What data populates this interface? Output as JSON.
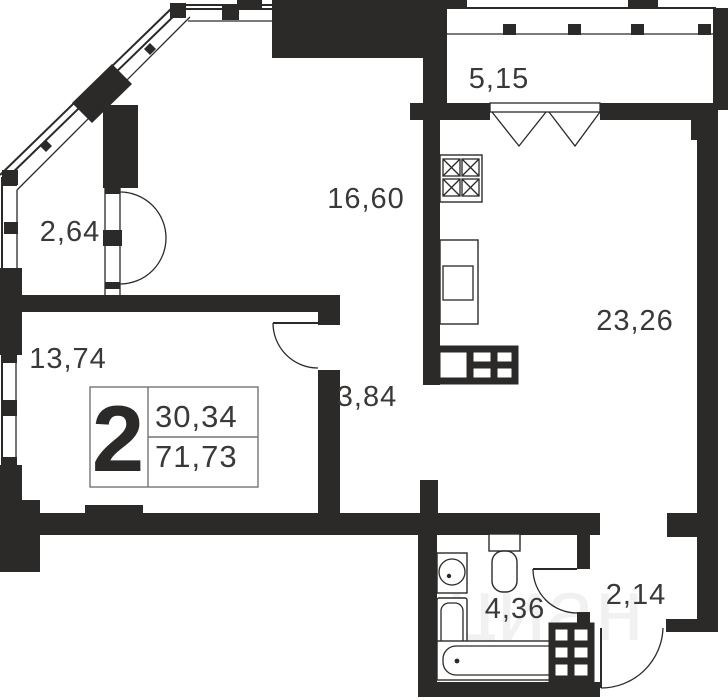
{
  "plan": {
    "type": "apartment-floor-plan",
    "badge": {
      "rooms_count": "2",
      "living_area": "30,34",
      "total_area": "71,73"
    },
    "rooms": [
      {
        "id": "loggia-left",
        "area": "2,64"
      },
      {
        "id": "living-top",
        "area": "16,60"
      },
      {
        "id": "balcony-top",
        "area": "5,15"
      },
      {
        "id": "kitchen-living",
        "area": "23,26"
      },
      {
        "id": "bedroom",
        "area": "13,74"
      },
      {
        "id": "hallway",
        "area": "3,84"
      },
      {
        "id": "bathroom",
        "area": "4,36"
      },
      {
        "id": "entry-hall",
        "area": "2,14"
      }
    ],
    "watermark": "циан",
    "colors": {
      "wall": "#2b2a29",
      "label": "#3a3938",
      "background": "#ffffff"
    }
  }
}
